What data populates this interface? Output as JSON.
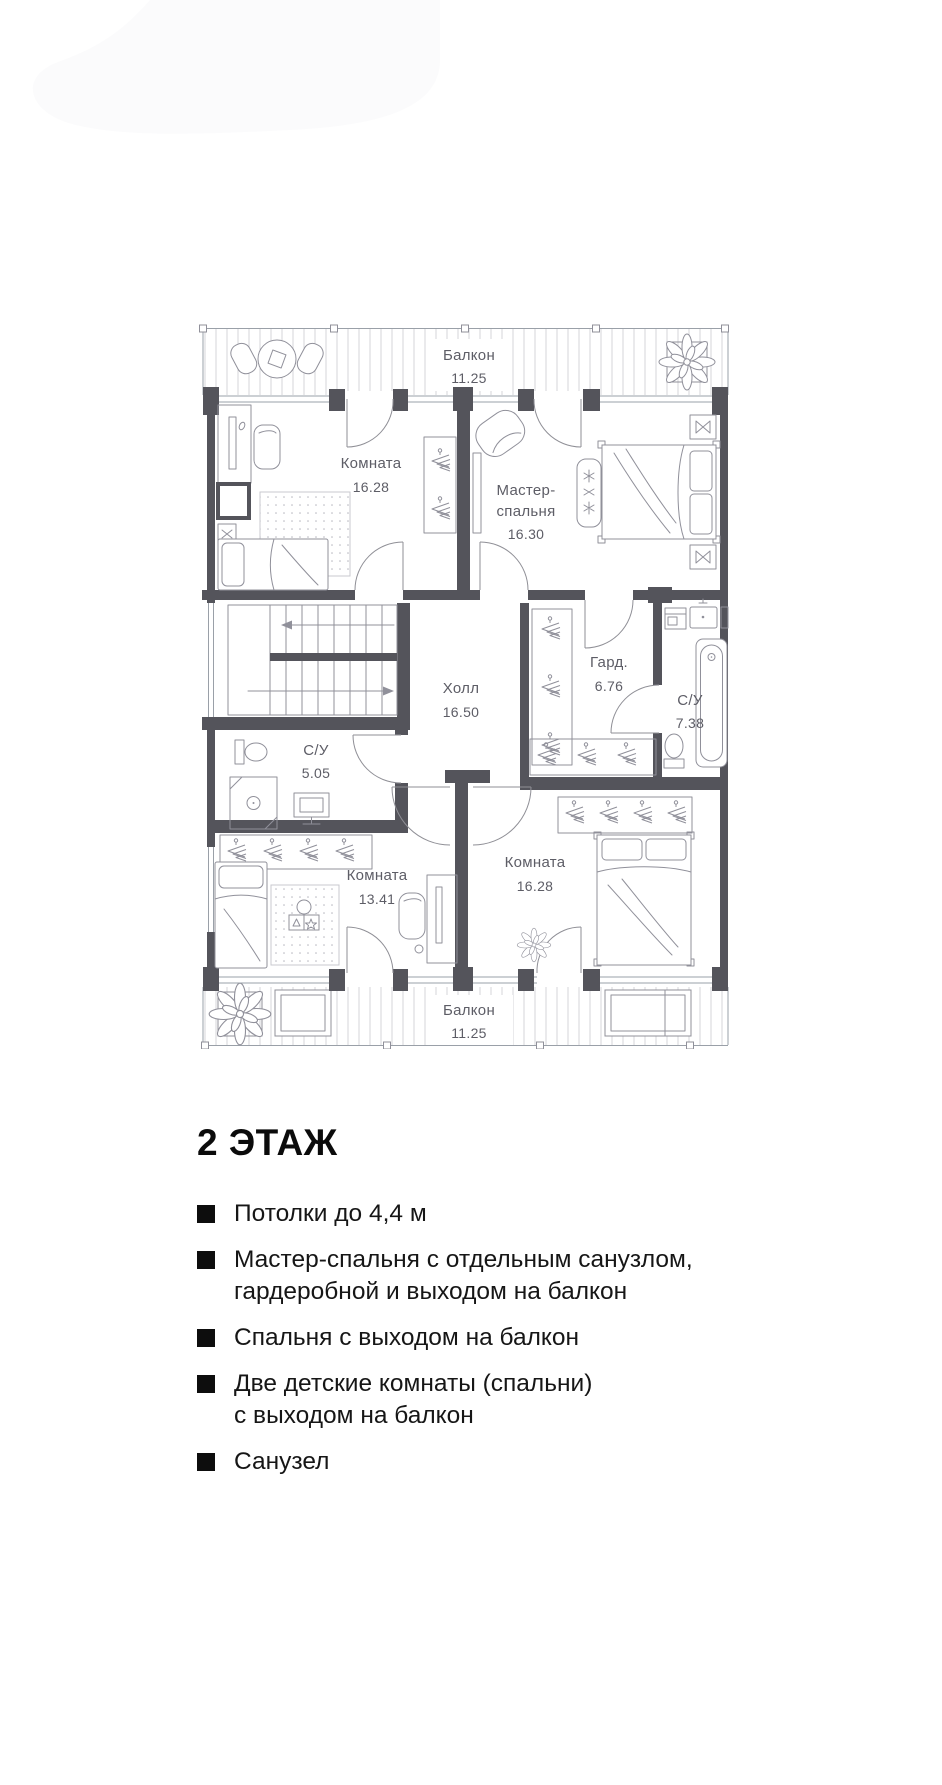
{
  "plan": {
    "colors": {
      "wall": "#54545b",
      "furniture_line": "#90909a",
      "hatch": "#d6d6da",
      "label": "#5d5d66"
    },
    "balcony_top": {
      "name": "Балкон",
      "area": "11.25"
    },
    "balcony_bottom": {
      "name": "Балкон",
      "area": "11.25"
    },
    "room_top_left": {
      "name": "Комната",
      "area": "16.28"
    },
    "master": {
      "name_line1": "Мастер-",
      "name_line2": "спальня",
      "area": "16.30"
    },
    "hall": {
      "name": "Холл",
      "area": "16.50"
    },
    "wardrobe": {
      "name": "Гард.",
      "area": "6.76"
    },
    "bath_master": {
      "name": "С/У",
      "area": "7.38"
    },
    "bath_small": {
      "name": "С/У",
      "area": "5.05"
    },
    "room_bottom_left": {
      "name": "Комната",
      "area": "13.41"
    },
    "room_bottom_right": {
      "name": "Комната",
      "area": "16.28"
    }
  },
  "section": {
    "title": "2 ЭТАЖ",
    "features": [
      {
        "line1": "Потолки до 4,4 м",
        "line2": ""
      },
      {
        "line1": "Мастер-спальня с отдельным санузлом,",
        "line2": "гардеробной и выходом на балкон"
      },
      {
        "line1": "Спальня с выходом на балкон",
        "line2": ""
      },
      {
        "line1": "Две детские комнаты (спальни)",
        "line2": "с выходом на балкон"
      },
      {
        "line1": "Санузел",
        "line2": ""
      }
    ]
  }
}
